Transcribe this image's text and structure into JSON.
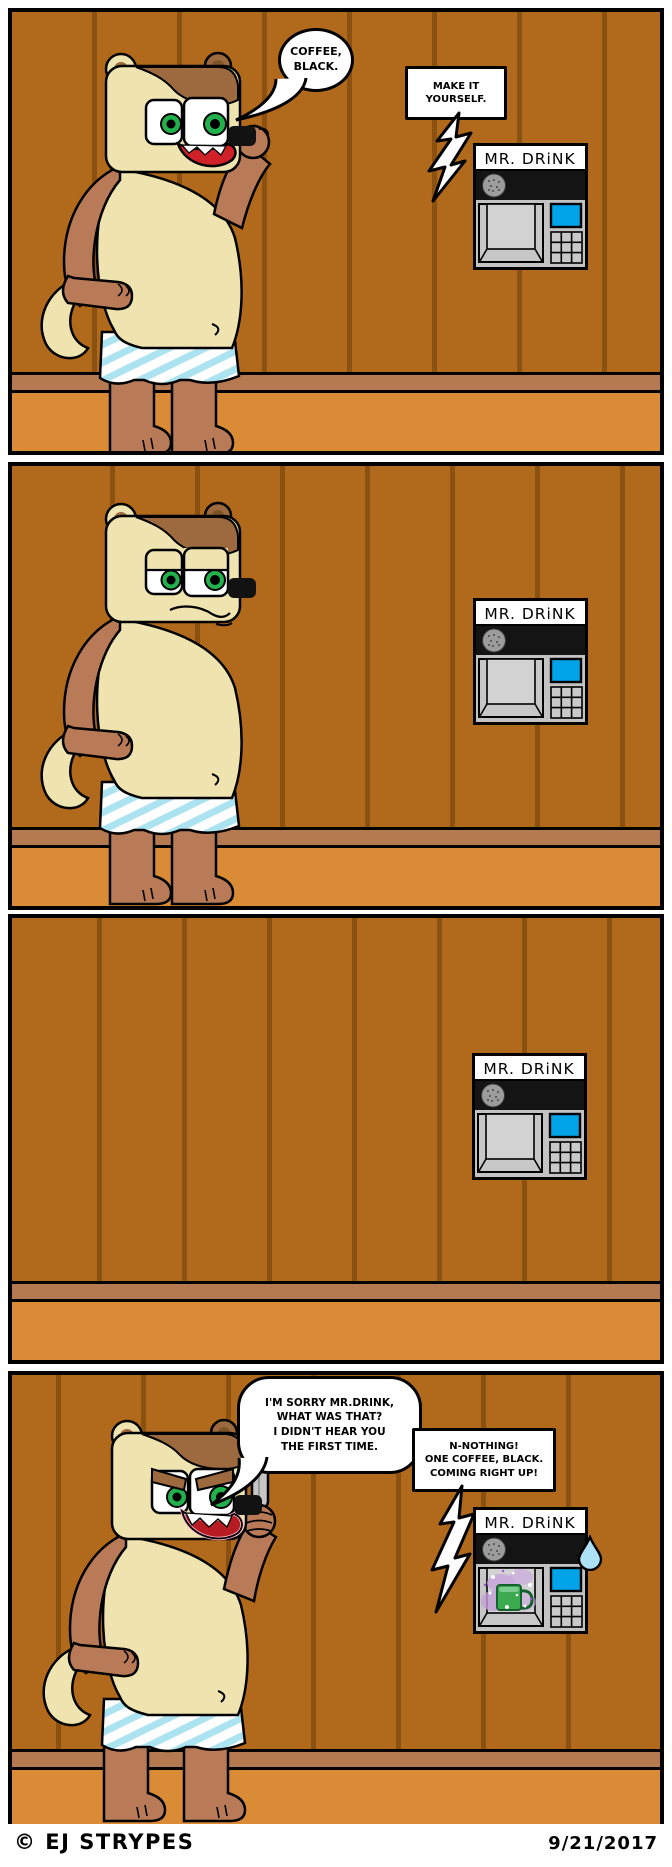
{
  "machine": {
    "label": "MR. DRiNK"
  },
  "panels": {
    "p1": {
      "bear_bubble": "COFFEE,\nBLACK.",
      "machine_bubble": "MAKE IT\nYOURSELF."
    },
    "p4": {
      "bear_bubble": "I'M SORRY MR.DRINK,\nWHAT WAS THAT?\nI DIDN'T HEAR YOU\nTHE FIRST TIME.",
      "machine_bubble": "N-NOTHING!\nONE COFFEE, BLACK.\nCOMING RIGHT UP!"
    }
  },
  "footer": {
    "credit": "© EJ STRYPES",
    "date": "9/21/2017"
  },
  "colors": {
    "wall": "#b1691c",
    "plank_line": "#8a5110",
    "baseboard": "#b67a50",
    "floor": "#da8b36",
    "bear_body": "#b97a57",
    "bear_cream": "#efe4b0",
    "bear_patch": "#9c6a3e",
    "eye_green": "#22b14c",
    "underwear_stripe": "#ace3f1",
    "machine_body": "#c3c3c3",
    "machine_screen": "#00a2e8",
    "mist": "#c9a6dd",
    "mug": "#3cab4f",
    "sweat": "#ade2f4"
  }
}
